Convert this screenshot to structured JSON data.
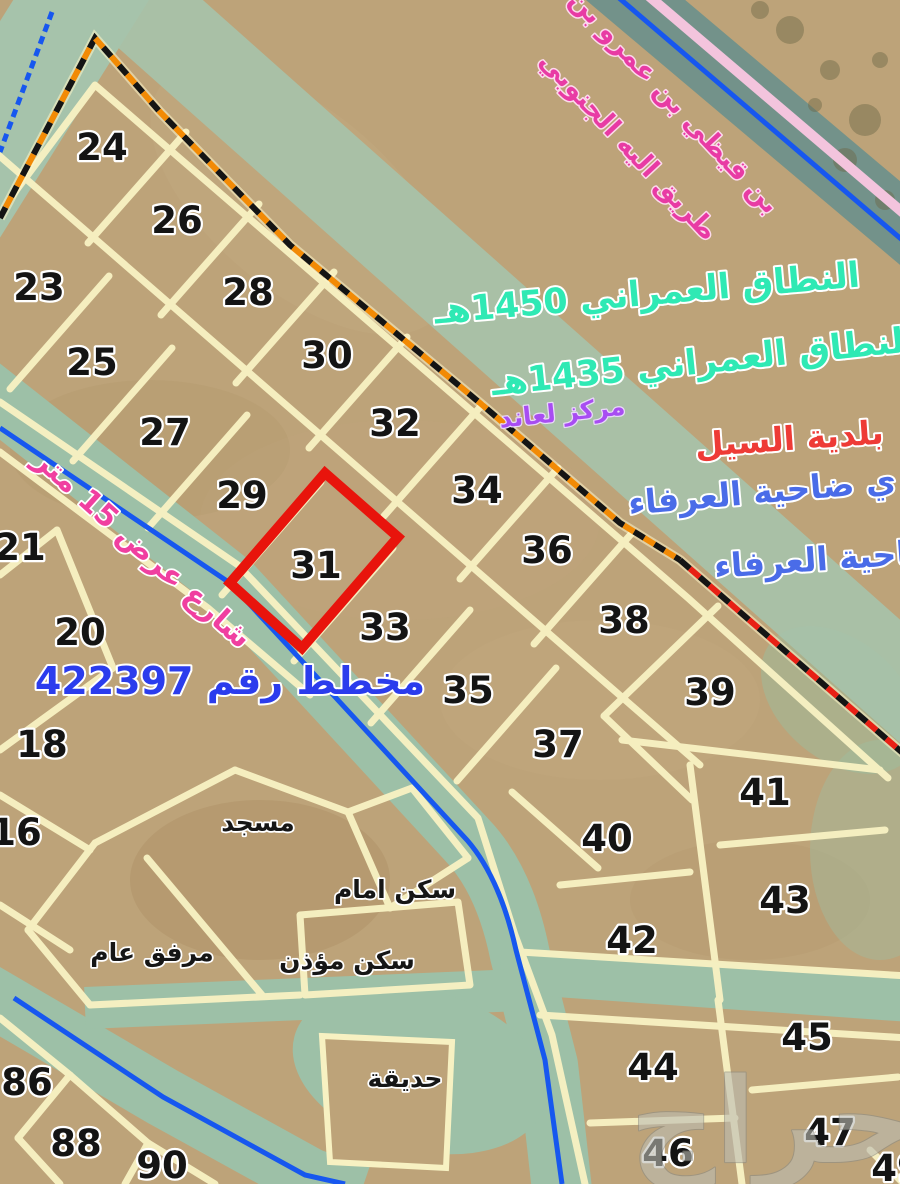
{
  "map": {
    "highlighted_plot": "31",
    "plots": [
      {
        "label": "24",
        "x": 102,
        "y": 147
      },
      {
        "label": "26",
        "x": 177,
        "y": 220
      },
      {
        "label": "23",
        "x": 39,
        "y": 287
      },
      {
        "label": "28",
        "x": 248,
        "y": 292
      },
      {
        "label": "25",
        "x": 92,
        "y": 362
      },
      {
        "label": "30",
        "x": 327,
        "y": 355
      },
      {
        "label": "27",
        "x": 165,
        "y": 432
      },
      {
        "label": "32",
        "x": 395,
        "y": 423
      },
      {
        "label": "29",
        "x": 242,
        "y": 495
      },
      {
        "label": "34",
        "x": 477,
        "y": 490
      },
      {
        "label": "21",
        "x": 20,
        "y": 547
      },
      {
        "label": "31",
        "x": 316,
        "y": 565
      },
      {
        "label": "36",
        "x": 547,
        "y": 550
      },
      {
        "label": "33",
        "x": 385,
        "y": 627
      },
      {
        "label": "38",
        "x": 624,
        "y": 620
      },
      {
        "label": "20",
        "x": 80,
        "y": 632
      },
      {
        "label": "35",
        "x": 468,
        "y": 690
      },
      {
        "label": "39",
        "x": 710,
        "y": 692
      },
      {
        "label": "18",
        "x": 42,
        "y": 744
      },
      {
        "label": "37",
        "x": 558,
        "y": 744
      },
      {
        "label": "41",
        "x": 765,
        "y": 792
      },
      {
        "label": "16",
        "x": 16,
        "y": 832
      },
      {
        "label": "40",
        "x": 607,
        "y": 838
      },
      {
        "label": "43",
        "x": 785,
        "y": 900
      },
      {
        "label": "42",
        "x": 632,
        "y": 940
      },
      {
        "label": "45",
        "x": 807,
        "y": 1037
      },
      {
        "label": "44",
        "x": 653,
        "y": 1067
      },
      {
        "label": "86",
        "x": 27,
        "y": 1082
      },
      {
        "label": "47",
        "x": 830,
        "y": 1132
      },
      {
        "label": "88",
        "x": 76,
        "y": 1143
      },
      {
        "label": "46",
        "x": 668,
        "y": 1153
      },
      {
        "label": "90",
        "x": 162,
        "y": 1165
      },
      {
        "label": "49",
        "x": 897,
        "y": 1168
      }
    ],
    "facilities": [
      {
        "name": "mosque",
        "label": "مسجد",
        "x": 258,
        "y": 822
      },
      {
        "name": "imam-residence",
        "label": "سكن امام",
        "x": 395,
        "y": 889
      },
      {
        "name": "muezzin-residence",
        "label": "سكن مؤذن",
        "x": 347,
        "y": 960
      },
      {
        "name": "public-facility",
        "label": "مرفق عام",
        "x": 152,
        "y": 952
      },
      {
        "name": "garden",
        "label": "حديقة",
        "x": 405,
        "y": 1078
      }
    ],
    "annotations": {
      "road_name_1": "بن قيظي بن عمرو بن",
      "road_name_2": "طريق اليه الجنوبي",
      "zone_1450": "النطاق العمراني 1450هـ",
      "zone_1435": "النطاق العمراني 1435هـ",
      "markaz": "مركز لعاند",
      "baladiya": "بلدية السيل",
      "district_line_1": "ي ضاحية العرفاء",
      "district_line_2": "ضاحية العرفاء",
      "street_15": "شارع عرض 15 متر",
      "plan_no": "مخطط رقم 422397",
      "watermark": "حراج"
    },
    "colors": {
      "sand": "#bda379",
      "road_green": "#9dc0a7",
      "road_dark": "#73928a",
      "plot_line": "#f7f1c2",
      "boundary_orange": "#f28a05",
      "boundary_red": "#e82015",
      "highlight_red": "#e8140c",
      "line_blue": "#1757ef",
      "line_pink": "#f3c4dd",
      "text_teal": "#2fe9b4",
      "text_red": "#ee3b36",
      "text_blue": "#4a6ce8",
      "text_purple": "#a84df2",
      "text_magenta": "#f03fa0",
      "plan_blue": "#2b3ced"
    }
  }
}
